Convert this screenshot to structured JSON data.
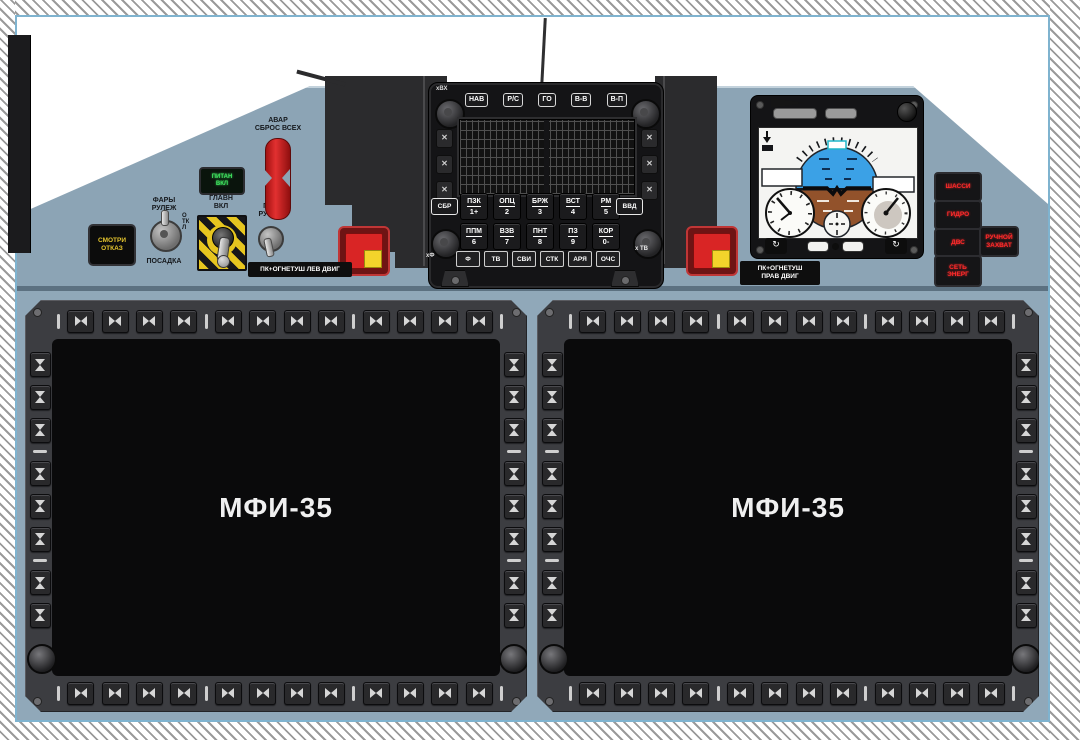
{
  "panel": {
    "bg": "#8ca4b5",
    "accent_border": "#7fb3cf"
  },
  "displays": {
    "title": "МФИ-35",
    "top_buttons": 12,
    "bottom_buttons": 12,
    "side_buttons": 8
  },
  "keyboard": {
    "corner_label": "хВХ",
    "mode_buttons": [
      "НАВ",
      "Р/С",
      "ГО",
      "В-В",
      "В-П"
    ],
    "clear_key": "СБР",
    "enter_key": "ВВД",
    "row1": [
      {
        "t": "ПЗК",
        "n": "1+"
      },
      {
        "t": "ОПЦ",
        "n": "2"
      },
      {
        "t": "БРЖ",
        "n": "3"
      },
      {
        "t": "ВСТ",
        "n": "4"
      },
      {
        "t": "РМ",
        "n": "5"
      }
    ],
    "row2": [
      {
        "t": "ППМ",
        "n": "6"
      },
      {
        "t": "ВЗВ",
        "n": "7"
      },
      {
        "t": "ПНТ",
        "n": "8"
      },
      {
        "t": "ПЗ",
        "n": "9"
      },
      {
        "t": "КОР",
        "n": "0-"
      }
    ],
    "row3": [
      "Ф",
      "ТВ",
      "СВИ",
      "СТК",
      "АРЯ",
      "ОЧС"
    ],
    "label_left": "хФ",
    "label_right": "х ТВ"
  },
  "left_controls": {
    "smotri": {
      "l1": "СМОТРИ",
      "l2": "ОТКАЗ"
    },
    "lights": {
      "l1": "ФАРЫ",
      "l2": "РУЛЕЖ",
      "bottom": "ПОСАДКА",
      "off": "ОТКЛ"
    },
    "green_annunciator": {
      "l1": "ПИТАН",
      "l2": "ВКЛ"
    },
    "main": {
      "l1": "ГЛАВН",
      "l2": "ВКЛ"
    },
    "pr": {
      "l1": "ПР",
      "l2": "РУЧН"
    },
    "avar": {
      "l1": "АВАР",
      "l2": "СБРОС ВСЕХ"
    }
  },
  "fire": {
    "left_label": "ПК+ОГНЕТУШ ЛЕВ ДВИГ",
    "right_l1": "ПК+ОГНЕТУШ",
    "right_l2": "ПРАВ ДВИГ"
  },
  "annunciators": {
    "a1": "ШАССИ",
    "a2": "ГИДРО",
    "a3": "ДВС",
    "a4_l1": "СЕТЬ",
    "a4_l2": "ЭНЕРГ",
    "a5_l1": "РУЧНОЙ",
    "a5_l2": "ЗАХВАТ"
  }
}
